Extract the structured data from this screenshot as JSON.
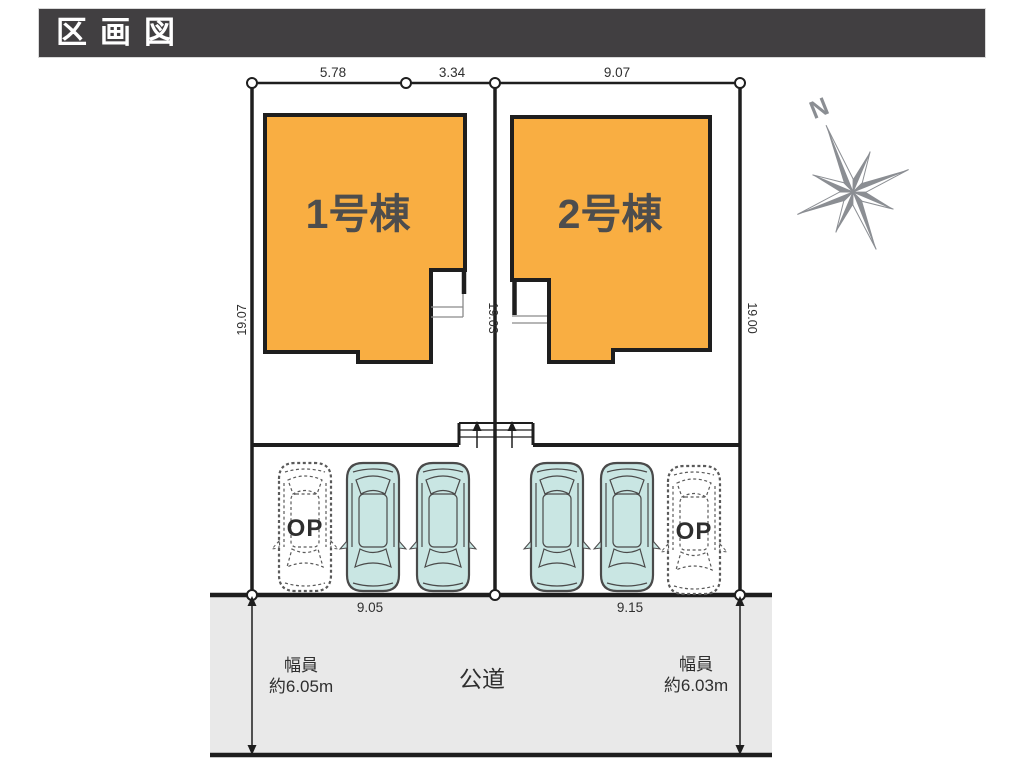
{
  "header": {
    "title": "区画図"
  },
  "site": {
    "buildings": [
      {
        "label": "1号棟"
      },
      {
        "label": "2号棟"
      }
    ],
    "dimensions": {
      "top": [
        "5.78",
        "3.34",
        "9.07"
      ],
      "sides": [
        "19.07",
        "19.03",
        "19.00"
      ],
      "bottom": [
        "9.05",
        "9.15"
      ]
    },
    "parking": {
      "op_label": "OP"
    }
  },
  "road": {
    "label": "公道",
    "width_left": {
      "line1": "幅員",
      "line2": "約6.05m"
    },
    "width_right": {
      "line1": "幅員",
      "line2": "約6.03m"
    }
  },
  "compass": {
    "north_label": "N"
  },
  "colors": {
    "header_bg": "#413F41",
    "building_fill": "#F9AE42",
    "car_fill": "#C9E6E3",
    "road_fill": "#E9E9E9",
    "compass_gray": "#8B8E93",
    "line": "#1E1E1E"
  }
}
